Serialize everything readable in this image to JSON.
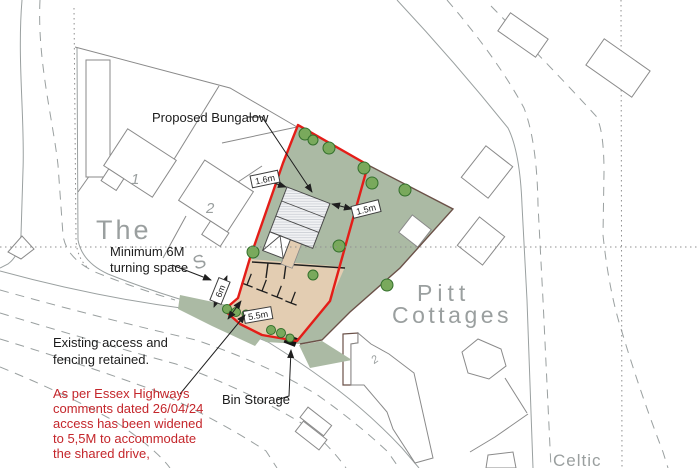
{
  "colors": {
    "boundary_red": "#e41d18",
    "site_green": "#abbaa4",
    "parking_tan": "#e3cdb2",
    "annotation_red": "#c4262b",
    "map_gray": "#9a9f9f",
    "line_gray": "#9aa0a0",
    "dark_boundary": "#6b5148",
    "black": "#1c1c1c",
    "tree_fill": "#79a95c",
    "tree_stroke": "#33702c",
    "hatch_bg": "#f1f2f4",
    "hatch_line": "#c6cbd0"
  },
  "annotations": {
    "proposed_bungalow": "Proposed Bungalow",
    "turning_line1": "Minimum 6M",
    "turning_line2": "turning space",
    "existing_line1": "Existing access and",
    "existing_line2": "fencing retained.",
    "highways_line1": "As per Essex Highways",
    "highways_line2": "comments dated 26/04/24",
    "highways_line3": "access has been widened",
    "highways_line4": "to 5,5M to accommodate",
    "highways_line5": "the shared drive,",
    "bin_storage": "Bin Storage"
  },
  "dimensions": {
    "gap_left": "1.6m",
    "gap_right": "1.5m",
    "access_width": "5.5m",
    "turning_depth": "6m"
  },
  "map_labels": {
    "street_the": "The",
    "street_s": "S",
    "house_1": "1",
    "house_2": "2",
    "pitt": "Pitt",
    "cottages": "Cottages",
    "celtic": "Celtic",
    "cottage_no": "2"
  }
}
